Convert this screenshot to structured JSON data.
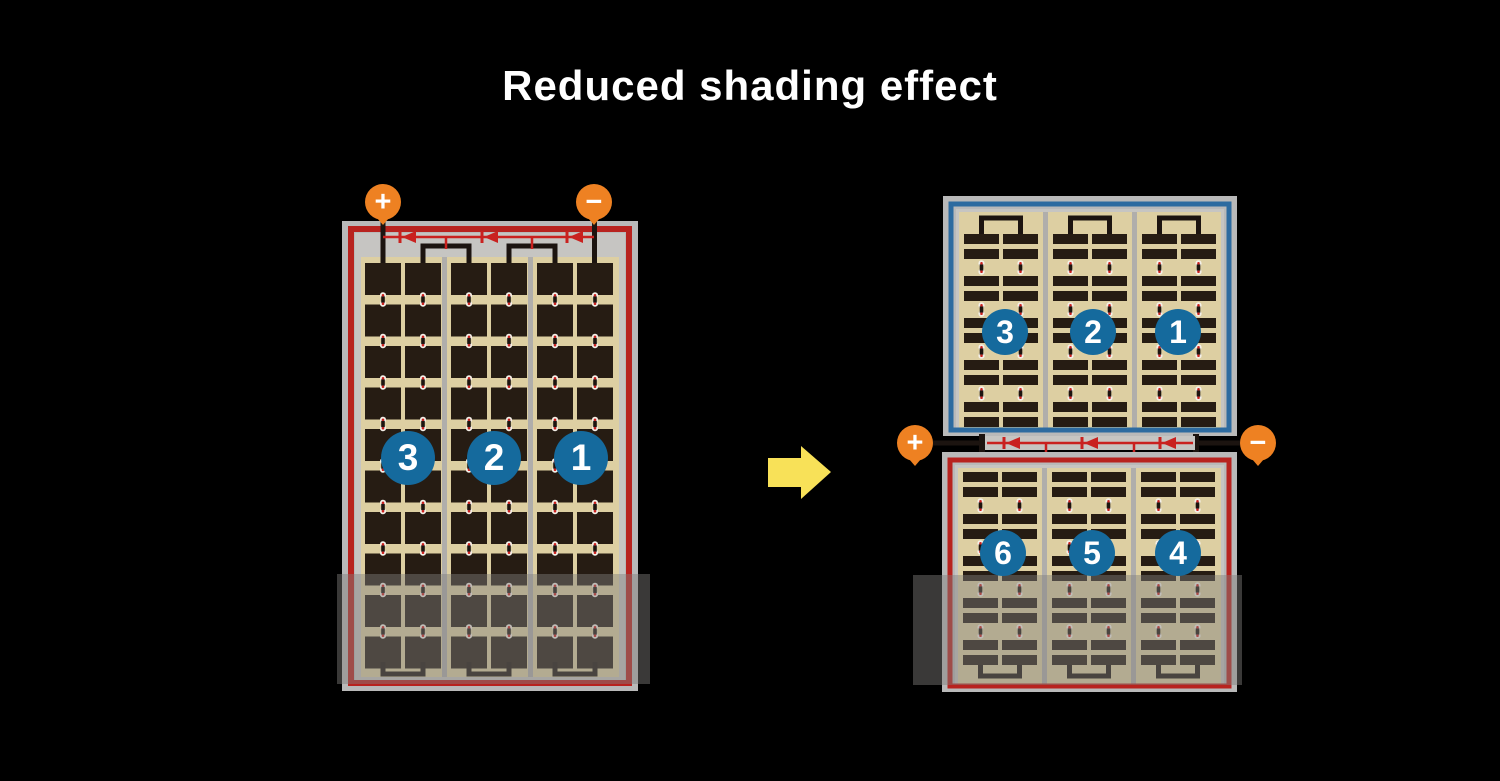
{
  "title": "Reduced shading effect",
  "left_module": {
    "terminals": {
      "plus": "+",
      "minus": "−"
    },
    "string_badges": [
      "3",
      "2",
      "1"
    ]
  },
  "right_module": {
    "terminals": {
      "plus": "+",
      "minus": "−"
    },
    "top_half_badges": [
      "3",
      "2",
      "1"
    ],
    "bottom_half_badges": [
      "6",
      "5",
      "4"
    ]
  },
  "colors": {
    "background": "#000000",
    "title_text": "#ffffff",
    "panel_frame_gray": "#b9b9b9",
    "panel_inner_gray": "#c6c5c2",
    "divider_gray": "#b0aeab",
    "cell_area_tan": "#ddcfa2",
    "cell_dark_brown": "#261c13",
    "busbar_black": "#1c1410",
    "border_red": "#b8231f",
    "diode_red": "#c9211f",
    "border_blue": "#2d6ba0",
    "badge_blue": "#156a9d",
    "badge_text": "#ffffff",
    "terminal_orange": "#ee8122",
    "terminal_text": "#ffffff",
    "arrow_yellow": "#f8e158",
    "dot_white": "#f4f0e8",
    "dot_red": "#c9211f",
    "shade_overlay": "rgba(128,126,124,0.45)"
  }
}
